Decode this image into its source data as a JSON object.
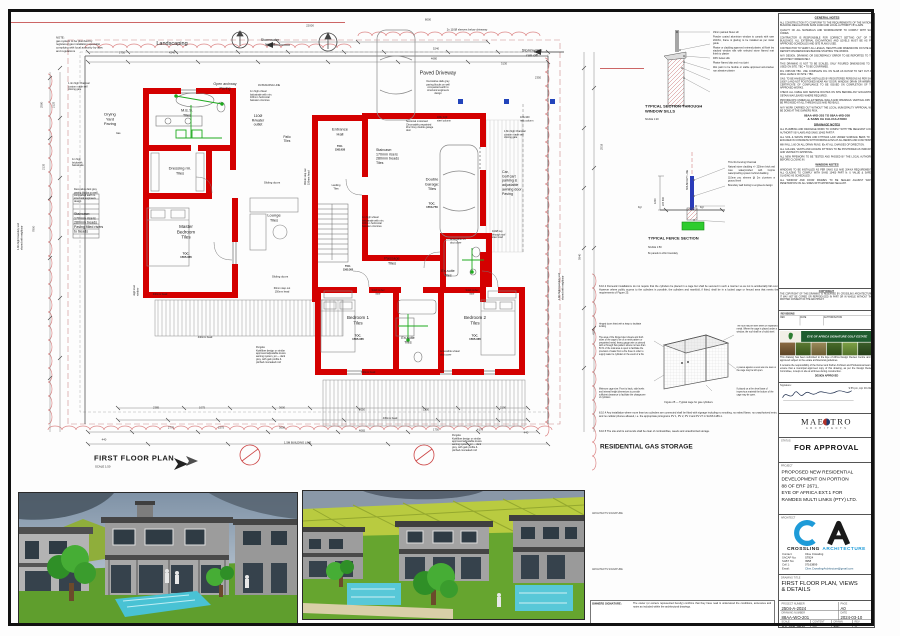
{
  "plan": {
    "title": "FIRST FLOOR PLAN",
    "scale": "SCALE 1:50",
    "labels": {
      "note": "NOTE:\ngas system to be plumbed by\nregistered gas installation specialist\ncomplying with local authority by-laws\nand regulations",
      "landscaping": "Landscaping",
      "landscaping_dim": "4240",
      "stormwater_left": "Stormwater\nrun off",
      "stormwater_right": "Stormwater\nrun off",
      "sleeves": "2x 110Ø sleeves below driveway",
      "open_archway": "Open archway\nPaving",
      "paved_driveway": "Paved Driveway",
      "paving_spec": "Decorative dark grey\npaving blocks on well\ncompacted earth to\nstructural engineers\ndesign",
      "drying_yard": "Drying\nYard\nPaving",
      "gas_point": "Gas",
      "mes": "M.E.S.\nTiles",
      "rwater": "110Ø\nR/water\noutlet",
      "patio": "Patio\nTiles",
      "dressing": "Dressing rm.\nTiles",
      "master_bedroom": "Master\nBedroom\nTiles",
      "master_toc": "TOC.\n1565.365",
      "lounge": "Lounge\nTiles",
      "entrance": "Entrance\nHall",
      "entrance_toc": "TOC.\n1565.630",
      "landing": "Landing\nTiles",
      "stair_center": "Staircase:\n170mm risers\n280mm treads\nTiles",
      "stair_left": "Staircase:\n170mm risers\n280mm treads\nPaving filled risers\nto treads",
      "garage": "Double\nGarage:\nTiles",
      "garage_toc": "TOC.\n1553.750",
      "garage_door": "Sectional motorised\nChromadek prepainted\nZinc Grey double garage\ndoor",
      "carport": "Car,\nGolf cart\nparking &\nadjustable\nawning door\nPaving",
      "gate_18": "1.8m high Charcoal\ncustom made self\nclosing gate",
      "gate_14": "1.4m high Charcoal\ncustom made self\nclosing gate",
      "passage": "Passage\nTiles",
      "passage_toc": "TOC.\n1565.365",
      "bedroom1": "Bedroom 1\nTiles",
      "bedroom1_toc": "TOC.\n1565.365",
      "ensuite_top": "En-suite\nTiles",
      "ensuite_mid": "En-suite\nTiles",
      "bedroom2": "Bedroom 2\nTiles",
      "bedroom2_toc": "TOC.\n1565.365",
      "sliding_doors_1": "Sliding doors",
      "sliding_doors_2": "Sliding doors",
      "pergola_left": "Pergola:\nKwikfibre design or similar\napproved adjustable louvre\nawning system, jet — dark\ngrey, with galv profile &\npitched concealed roof",
      "pergola_bottom": "Pergola:\nKwikfibre design or similar\napproved adjustable louvre\nawning system, jet — dark\ngrey, with galv profile &\npitched concealed roof",
      "head_440_a": "440mm head",
      "head_440_b": "440mm head",
      "head_440_c": "440mm head",
      "head_445": "445mm head",
      "step_out": "60mm step out\n150mm head",
      "step_out_rot": "30mm step out\n150mm head",
      "duct_top": "Accessible s/s\nduct cover",
      "duct_bottom": "Accessible s/steel\nduct cover",
      "svp": "110Ø svp\nthrough roof\nsteel cowl",
      "column_1": "100x 100\nsteel column",
      "column_2": "100x100\nrsec column",
      "building_line_1m": "1M BUILDING LINE",
      "building_line_15m": "1.5M BUILDING LINE",
      "balustrade_top": "1m high c/steel\nbalustrade with min.\n100mm horizontal\nbaluster c/centres",
      "balustrade_stair": "1m high s/steel\nbalustrade with min.\n100mm horizontal\nbaluster c/centres",
      "brick_balustrade": "1m high\nbrickwork\nbalustrade",
      "paving_spec_left": "Decorative dark grey\npaving blocks on well\ncompacted earth to\nstructural engineers\ndesign",
      "boundary_left": "1.8m high boundary wall\nshared with neighbour",
      "boundary_right": "1.8m high boundary wall\nshared with neighbour",
      "solid_timber_1": "Solid timber\ndoor",
      "solid_timber_2": "Solid timber\ndoor",
      "highlevel": "High level\nwindow"
    },
    "dims": [
      "22000",
      "8000",
      "5240",
      "4680",
      "3130",
      "2350",
      "1750",
      "2775",
      "1575",
      "3600",
      "4065",
      "2385",
      "1075",
      "3600",
      "2050",
      "1200",
      "2190",
      "1750",
      "4170",
      "440",
      "440",
      "5940",
      "4150",
      "2518",
      "2580",
      "2125",
      "2135",
      "7800"
    ]
  },
  "window_sill_detail": {
    "title": "TYPICAL SECTION THROUGH\nWINDOW SILLS",
    "scale": "SCALE 1:20",
    "callouts": [
      "15mm painted Nutec sill",
      "Powder coated aluminium window to comply with sans 204/XA, frame & glazing to be installed as per install guide",
      "Plaster or cladding approved external plaster, all flush low stacked window sills with selected stone flamed matt finish to plaster",
      "DPC below sills",
      "Plaster flamed drip and v-cut joint",
      "Wet paint to be flexible or stable approved anti-cracked non abrasive plaster"
    ]
  },
  "fence_detail": {
    "title": "TYPICAL FENCE SECTION",
    "scale": "SCALE 1:50",
    "note": "8x panels to 22m boundary",
    "boundary_line": "BOUNDARY LINE",
    "dim_1200": "1200",
    "dim_225": "225  600",
    "fgl_left": "Fgl",
    "fgl_right": "Fgl",
    "callouts": [
      "Thru Ru Fencing Charcoal",
      "Natural stone cladding +/- 220mm brick wall max. waterproofed with Coprox waterproofing system behind cladding",
      "110mm pvc sleeves @ 2m c/centres at ground level",
      "Boundary wall footing to engineers design"
    ]
  },
  "gas_storage": {
    "p1": "8.10.2  Domestic installations do not require that the cylinders be placed in a cage but shall be secured in such a manner so as not to accidentally fall over. However where public access to the cylinders is possible, the cylinders and manifold, if fitted, shall be in a locked cage or fenced area that meets the requirements of Figure 25.",
    "callouts_left": [
      "Hinged doors fitted with a hasp to facilitate locking",
      "The area of the hinged door sheets and both sides of the cage to be of a mesh pattern or prepainted metal, heavy gauge wire or pierced with a through flow pattern where not less than 50 % of the total area is open to facilitate the provision of water from a fire hose in order to supply water to cylinders in the event of a fire",
      "Minimum cage size:\nFront to back, side levels and internal height dimensions to provide sufficient clearance to facilitate the changeover of cylinders"
    ],
    "callouts_right": [
      "The roof may be steel sheet or expanded metal. Where the cage is placed under a window, the roof shall be of solid steel.",
      "If placed against a solid wall the back of the cage may be left open.",
      "If placed on a firm level base of impervious material the bottom of the cage may be open."
    ],
    "figure_caption": "Figure 25 — Typical cage for gas cylinders",
    "p2": "8.10.4  Any installation where more than two cylinders are connected shall be fitted with signage including no smoking, no naked flame, no unauthorized entry and no cellular phones allowed, i.e. the appropriate pictograms PV 1, PV 2, PV 3 and PV 27 in SANS 1186-1.",
    "p3": "8.10.5  The site and its surrounds shall be clear of combustibles, weeds and unauthorized storage.",
    "title": "RESIDENTIAL GAS STORAGE"
  },
  "notes_column": {
    "general_title": "GENERAL NOTES",
    "general": [
      "ALL CONSTRUCTION TO CONFORM TO THE REQUIREMENTS OF THE NATIONAL BUILDING REGULATIONS SANS 10400 AND LOCAL AUTHORITY BY-LAWS.",
      "QUALITY OF ALL MATERIALS AND WORKMANSHIP TO COMPLY WITH SANS CODES.",
      "CONTRACTOR IS RESPONSIBLE FOR CORRECT SETTING OUT OF THE BUILDINGS. ALL EXTERNAL EXCAVATIONS AND LEVELS MUST BE AS PER APPROVED SCHEDULES AND SITE PLANS USED.",
      "CONTRACTOR TO VERIFY ALL LEVELS, HEIGHTS AND DIMENSIONS ON SITE AND REPORT DISCREPANCIES BEFORE STARTING THE WORKS.",
      "ANY DESIGN, DRAWING OR DISCREPANCY ERROR TO BE REPORTED TO THE ARCHITECT IMMEDIATELY.",
      "THIS DRAWING IS NOT TO BE SCALED; ONLY FIGURED DIMENSIONS TO BE USED ON SITE. TBC = TO BE CONFIRMED.",
      "FFL 1565.630 TBC. USE COMPLETE FFL ON SLAB AS DATUM TO SET OUT ALL WALL LEVELS ON SITE / TBC.",
      "GAS: TO BE HANDLED AND INSTALLED BY REGISTERED PERSONS AS PER SANS 10087-1 AND NOT POSITIONED NEAR ANY DOOR, WINDOW, DRAIN OR AIRBRICK. CERTIFICATE OF COMPLIANCE TO BE ISSUED ON COMPLETION OF THE APPROVED WORKS.",
      "CHECK ALL CABLE AND SERVICE ROUTES ON SITE BEFORE ANY EXCAVATION. OBTAIN WAYLEAVES WHERE REQUIRED.",
      "PROVIDE DPC UNDER ALL EXTERNAL WALLS AND OPENINGS. VERTICAL DPC TO BE PROVIDED AT ALL THRESHOLDS AND REVEALS.",
      "ANY WORK CARRIED OUT WITHOUT THE LOCAL MUNICIPALITY APPROVAL WILL BE DONE AT THE OWNERS RISK."
    ],
    "ref_line": "88AA-WO-203 TO 88AA-WD-208\n& SANS XA CALCULATION",
    "drainage_title": "DRAINAGE NOTES",
    "drainage": [
      "ALL PLUMBING AND DRAINAGE WORK TO COMPLY WITH THE RELEVANT LOCAL AUTHORITY BY-LAWS AND SANS 10400 PART P.",
      "ALL SOIL & WASTE PIPES AND FITTINGS LAID UNDER SURFACE BEDS TO BE ENCASED IN CONCRETE WITH RODDING EYES AT ALL BENDS AND JUNCTIONS.",
      "MIN FALL 1:60 ON ALL DRAIN RUNS. IEs AT ALL CHANGES OF DIRECTION.",
      "ALL GULLIES, VENTS AND ACCESS FITTINGS TO BE POSITIONED AS INDICATED AND VENTED TO APPROVAL.",
      "ALL NEW PIPEWORK TO BE TESTED AND PASSED BY THE LOCAL AUTHORITY BEFORE CLOSING IN."
    ],
    "window_title": "WINDOW NOTES",
    "window": [
      "WINDOWS TO BE INSTALLED AS PER SANS 613 AND 204/XA REQUIREMENTS. ALL GLAZING TO COMPLY WITH SANS 10400 PART N: U VALUE & SAFETY GLAZING AS SCHEDULED.",
      "ALL WINDOW AND DOOR FRAMES TO BE SEALED AGAINST WATER PENETRATION ON ALL SIDES WITH APPROVED SEALANT."
    ]
  },
  "copyright": {
    "title": "COPYRIGHT",
    "text": "THE COPYRIGHT OF THIS DRAWING IS RESERVED BY CROSSLING ARCHITECTURE. IT MAY NOT BE COPIED OR REPRODUCED IN PART OR IN WHOLE WITHOUT THE WRITTEN CONSENT OF THE ARCHITECT."
  },
  "revisions": {
    "title": "REVISIONS",
    "headers": [
      "REV",
      "DATE",
      "AUTHORISATION"
    ]
  },
  "estate": {
    "banner": "EYE OF AFRICA SIGNATURE GOLF ESTATE",
    "p1": "This drawing has been submitted to the Eye of Africa Design Review Centre and is approved subject to the estate architectural guidelines.",
    "p2": "It remains the responsibility of the Owner and his/her Architect and Professional team to ensure that a municipal approved copy of this drawing, as per the Design Review Committee, is kept on site at all times during construction.",
    "approved": "DESIGN APPROVED"
  },
  "signature": {
    "label": "Signature:",
    "date": "9:55 pm, Apr 03 2024"
  },
  "maestro": {
    "name": "MAESTRO",
    "sub": "A R C H I T E C T S"
  },
  "status": {
    "label": "STATUS",
    "value": "FOR APPROVAL"
  },
  "project": {
    "label": "PROJECT",
    "text": "PROPOSED NEW RESIDENTIAL\nDEVELOPMENT ON PORTION\n88 OF ERF 2671,\nEYE OF AFRICA EXT.1 FOR\nRAMDES MULTI LINKS (PTY) LTD."
  },
  "firm": {
    "label": "ARCHITECT",
    "name_1": "CROSSLING",
    "name_2": "ARCHITECTURE",
    "contact_labels": [
      "Contact:",
      "SACAP No:",
      "SABT No:",
      "Cell 1:",
      "Email:"
    ],
    "contact_values": [
      "Clive Crossling",
      "ST824",
      "3958",
      "07163899",
      "Clive.CrosslingArchitecture@gmail.com"
    ]
  },
  "drawing": {
    "label": "DRAWING TITLE",
    "value": "FIRST FLOOR PLAN, VIEWS\n& DETAILS"
  },
  "meta": {
    "project_number_label": "PROJECT NUMBER",
    "project_number": "2504-A-2024",
    "page_label": "PAGE",
    "page": "A0",
    "drawing_number_label": "DRAWING NUMBER",
    "drawing_number": "88AA-WO-201",
    "date_label": "DATE",
    "date": "2024-03-10",
    "scale_label": "SCALE",
    "scale": "AS SHOWN",
    "content_label": "CONTENT",
    "content": "—",
    "drawn_label": "DRAWN",
    "drawn": "ME",
    "rev_label": "REV",
    "rev": "4"
  },
  "views": {
    "v3": "VIEW 3",
    "v4": "VIEW 4"
  },
  "signature_labels": {
    "architects_1": "ARCHITECTS SIGNATURE",
    "architects_2": "ARCHITECTS SIGNATURE",
    "owners_title": "OWNERS SIGNATURE:",
    "owners_text": "The owner (or owners represented hereby) confirms that they have read & understood the conditions, annexures and notes as included within the architectural drawings."
  },
  "colors": {
    "wall_red": "#d40000",
    "accent_blue": "#1e9bd8",
    "estate_green": "#1f5c2f",
    "plumb_green": "#1faa1f"
  }
}
